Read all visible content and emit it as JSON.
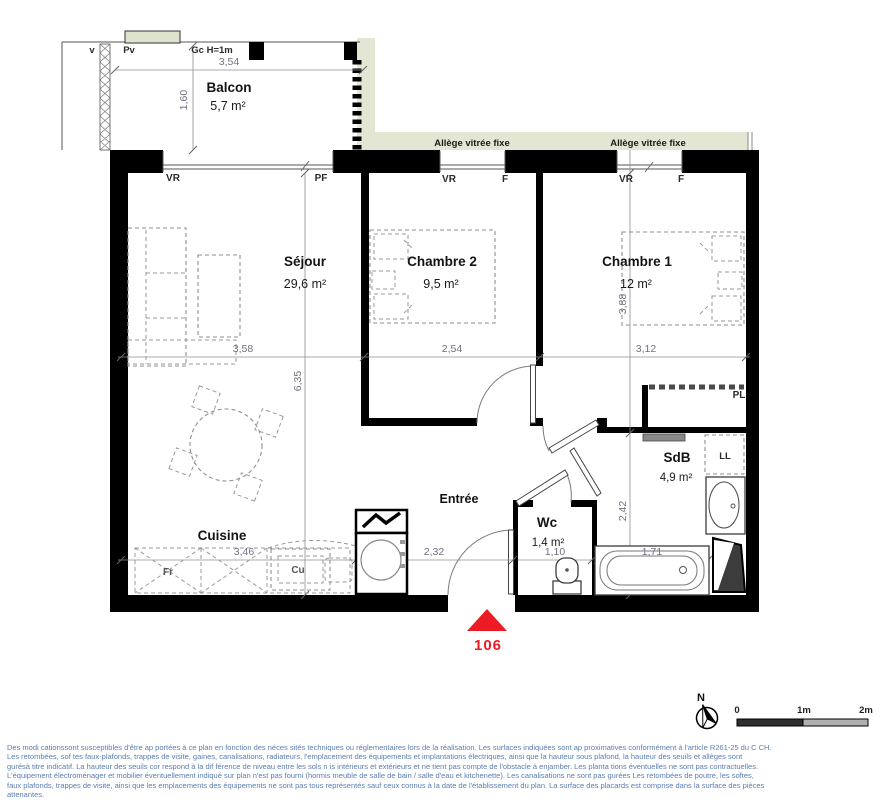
{
  "plan": {
    "unit_number": "106",
    "rooms": {
      "balcon": {
        "name": "Balcon",
        "area": "5,7 m²"
      },
      "sejour": {
        "name": "Séjour",
        "area": "29,6 m²"
      },
      "chambre2": {
        "name": "Chambre 2",
        "area": "9,5 m²"
      },
      "chambre1": {
        "name": "Chambre 1",
        "area": "12 m²"
      },
      "cuisine": {
        "name": "Cuisine"
      },
      "entree": {
        "name": "Entrée"
      },
      "wc": {
        "name": "Wc",
        "area": "1,4 m²"
      },
      "sdb": {
        "name": "SdB",
        "area": "4,9 m²"
      }
    },
    "annotations": {
      "pv": "Pv",
      "pv_partial": "v",
      "gc": "Gc H=1m",
      "vr": "VR",
      "pf": "PF",
      "f": "F",
      "allege": "Allège vitrée fixe",
      "pl": "PL",
      "ll": "LL",
      "fr": "Fr",
      "cu": "Cu"
    },
    "dimensions": {
      "balcony_w": "3,54",
      "balcony_d": "1,60",
      "sejour_w": "3,58",
      "chambre2_w": "2,54",
      "chambre1_w": "3,12",
      "sejour_h": "6,35",
      "chambre1_h": "3,88",
      "sdb_h": "2,42",
      "cuisine_w": "3,46",
      "entree_w": "2,32",
      "wc_w": "1,10",
      "bath_w": "1,71"
    },
    "compass": {
      "north": "N"
    },
    "scale_bar": {
      "zero": "0",
      "one": "1m",
      "two": "2m"
    },
    "colors": {
      "accent_red": "#ed1c24",
      "exterior_band": "#e3e6d3",
      "disclaimer_text": "#5b7db1"
    }
  },
  "footer": {
    "disclaimer": [
      "Des modi cationssont susceptibles d'être ap  portées à ce plan en fonction des néces sités techniques ou réglementaires lors de la réalisation. Les surfaces indiquées sont ap  proximatives conformément à l'article R261-25 du C  CH.",
      "Les retombées, sof tes  faux-plafonds, trappes de visite, gaines, canalisations, radiateurs, l'emplacement des équipements et implantations électriques, ainsi que la hauteur sous plafond, la hauteur des seuils et allèges sont",
      " gurésà titre indicatif. La hauteur des seuils cor  respond à la dif férence de niveau entre les sols n  is intérieurs et extérieurs et ne tient pas compte de l'obstacle à  enjamber. Les planta tions éventuelles ne sont pas contractuelles.",
      "L'équipement électroménager et mobilier éventuellement indiqué sur plan n'est pas fourni (hormis meuble de salle de bain / salle d'eau et kitchenette). Les canalisations ne sont pas  gurées Les retombées de poutre, les softes,",
      "faux plafonds, trappes de visite, ainsi que les emplacements des équipements ne sont pas tous représentés sauf ceux connus à la date de l'établissement du plan. La surface des placards est comprise dans la surface des pièces",
      "attenantes."
    ]
  }
}
